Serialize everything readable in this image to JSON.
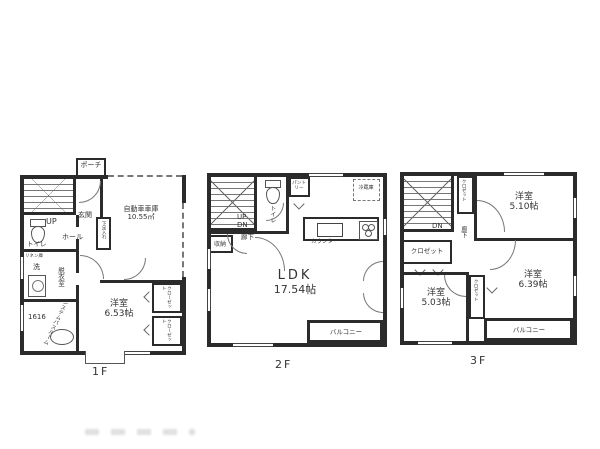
{
  "document": {
    "type": "floor-plan",
    "wall_color": "#2b2b2b",
    "paper_color": "#ffffff"
  },
  "floors": {
    "f1": {
      "floor_label": "1F",
      "porch": "ポーチ",
      "entrance": "玄関",
      "up": "UP",
      "hall": "ホール",
      "toilet": "トイレ",
      "shoe_cabinet": "下足入れ",
      "linen": "リネン庫",
      "wash": "洗",
      "dressing_room": "脱衣室",
      "bath_name": "システムバスルーム",
      "bath_size": "1616",
      "garage_name": "自動車車庫",
      "garage_area": "10.55㎡",
      "room_name": "洋室",
      "room_size": "6.53帖",
      "closet_upper": "クローゼット",
      "closet_lower": "クローゼット"
    },
    "f2": {
      "floor_label": "2F",
      "up": "UP",
      "dn": "DN",
      "toilet": "トイレ",
      "pantry": "パントリー",
      "fridge": "冷蔵庫",
      "hallway": "廊下",
      "storage": "収納",
      "counter": "カウンター",
      "ldk_name": "LDK",
      "ldk_size": "17.54帖",
      "balcony": "バルコニー"
    },
    "f3": {
      "floor_label": "3F",
      "dn": "DN",
      "closet_top": "クロゼット",
      "hallway": "廊下",
      "closet_left": "クロゼット",
      "closet_mid": "クロゼット",
      "room1_name": "洋室",
      "room1_size": "5.10帖",
      "room2_name": "洋室",
      "room2_size": "6.39帖",
      "room3_name": "洋室",
      "room3_size": "5.03帖",
      "balcony": "バルコニー"
    }
  }
}
